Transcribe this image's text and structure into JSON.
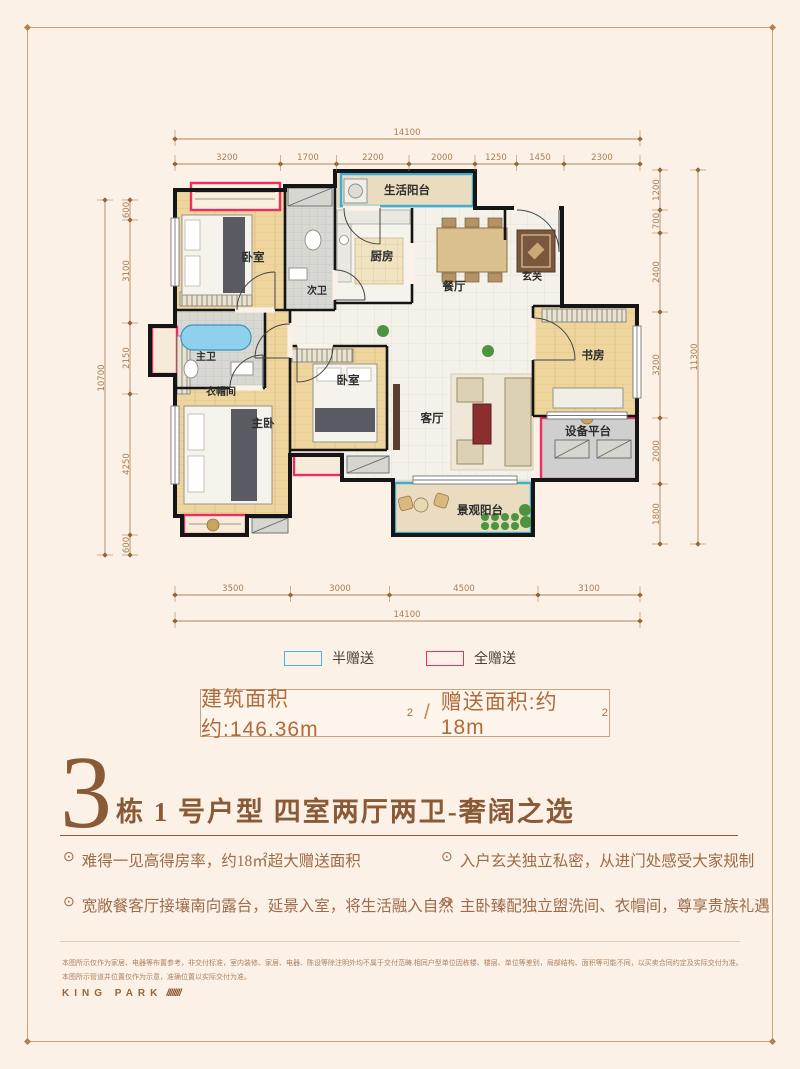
{
  "legend": {
    "half": {
      "label": "半赠送",
      "color": "#45b5d8"
    },
    "full": {
      "label": "全赠送",
      "color": "#ee2d63"
    }
  },
  "area_banner": {
    "left_text": "建筑面积约:146.36m",
    "left_sup": "2",
    "divider": "/",
    "right_text": "赠送面积:约18m",
    "right_sup": "2"
  },
  "title": {
    "big": "3",
    "rest": "栋 1 号户型  四室两厅两卫-奢阔之选"
  },
  "features": [
    "难得一见高得房率，约18㎡超大赠送面积",
    "宽敞餐客厅接壤南向露台，延景入室，将生活融入自然",
    "入户玄关独立私密，从进门处感受大家规制",
    "主卧臻配独立盥洗间、衣帽间，尊享贵族礼遇"
  ],
  "disclaimer": {
    "line1": "本图所示仅作为家居、电器等布置参考，非交付标准，室内装修、家居、电器、陈设等除注明外均不属于交付范畴.相同户型单位因栋楼、楼层、单位等差别，局部结构、面积等可能不同，以买卖合同约定及实际交付为准。",
    "line2": "本图所示管道井位置仅作为示意，准确位置以实际交付为准。",
    "brand": "KING PARK",
    "slashes": "////////"
  },
  "plan": {
    "rooms": {
      "bedroom_top": "卧室",
      "bath_second": "次卫",
      "kitchen": "厨房",
      "life_balcony": "生活阳台",
      "dining": "餐厅",
      "foyer": "玄关",
      "study": "书房",
      "equipment_platform": "设备平台",
      "view_balcony": "景观阳台",
      "living": "客厅",
      "bedroom_mid": "卧室",
      "master": "主卧",
      "cloakroom": "衣帽间",
      "bath_master": "主卫"
    },
    "dims": {
      "top_total": "14100",
      "top": [
        "3200",
        "1700",
        "2200",
        "2000",
        "1250",
        "1450",
        "2300"
      ],
      "bottom": [
        "3500",
        "3000",
        "4500",
        "3100"
      ],
      "bottom_total": "14100",
      "left": [
        "600",
        "3100",
        "2150",
        "4250",
        "600"
      ],
      "left_total": "10700",
      "right": [
        "1200",
        "700",
        "2400",
        "3200",
        "2000",
        "1800"
      ],
      "right_total": "11300"
    }
  }
}
